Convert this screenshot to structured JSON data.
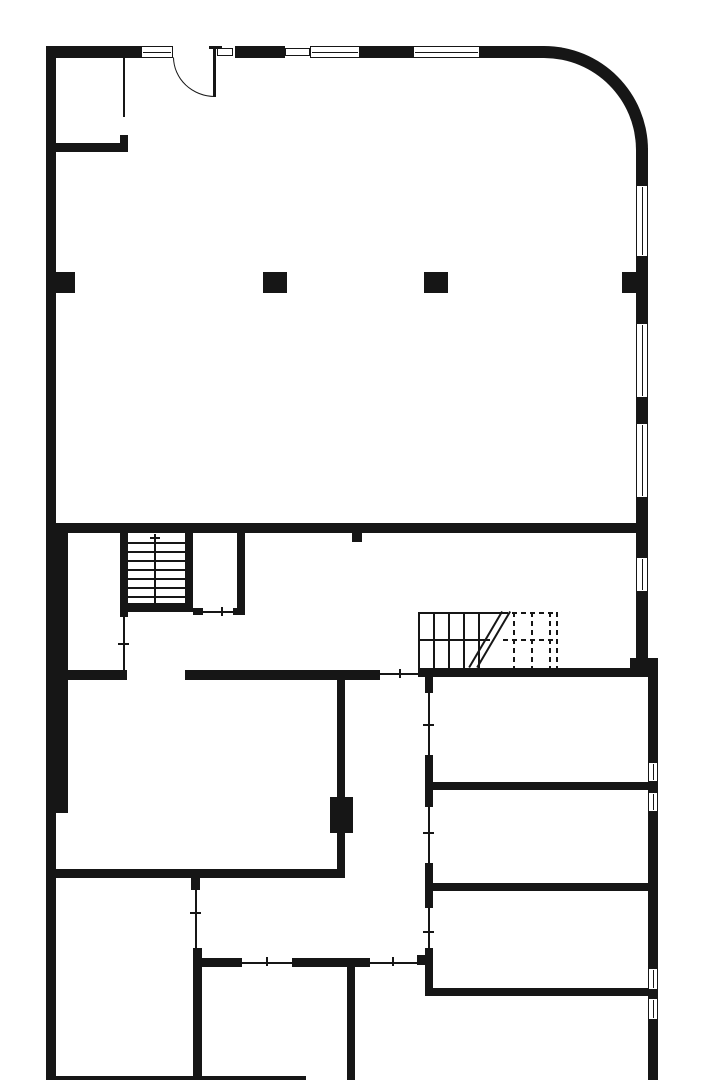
{
  "page": {
    "title": "ground-floor-plan",
    "background_color": "#ffffff",
    "ink_color": "#161616",
    "canvas_width": 720,
    "canvas_height": 1080
  },
  "elements": [
    {
      "name": "outer-wall-left",
      "type": "rect",
      "x": 46,
      "y": 48,
      "w": 10,
      "h": 1032
    },
    {
      "name": "wall-left-inner-thickening",
      "type": "rect",
      "x": 56,
      "y": 525,
      "w": 12,
      "h": 288
    },
    {
      "name": "top-wall-segment",
      "type": "rect",
      "x": 46,
      "y": 46,
      "w": 95,
      "h": 12
    },
    {
      "name": "window",
      "type": "window",
      "x": 141,
      "y": 46,
      "w": 32,
      "h": 12,
      "mid": true
    },
    {
      "name": "door-leaf",
      "type": "rect",
      "x": 213,
      "y": 47,
      "w": 3,
      "h": 50
    },
    {
      "name": "door-hinge-cap",
      "type": "rect",
      "x": 209,
      "y": 46,
      "w": 13,
      "h": 3
    },
    {
      "name": "door-swing-arc",
      "type": "arc",
      "x": 173,
      "y": 57,
      "w": 42,
      "h": 40
    },
    {
      "name": "window-sill",
      "type": "window",
      "x": 217,
      "y": 48,
      "w": 16,
      "h": 8
    },
    {
      "name": "top-wall-segment",
      "type": "rect",
      "x": 235,
      "y": 46,
      "w": 50,
      "h": 12
    },
    {
      "name": "window",
      "type": "window",
      "x": 285,
      "y": 48,
      "w": 25,
      "h": 8
    },
    {
      "name": "window",
      "type": "window",
      "x": 310,
      "y": 46,
      "w": 50,
      "h": 12,
      "mid": true
    },
    {
      "name": "top-wall-segment",
      "type": "rect",
      "x": 360,
      "y": 46,
      "w": 53,
      "h": 12
    },
    {
      "name": "window",
      "type": "window",
      "x": 413,
      "y": 46,
      "w": 67,
      "h": 12,
      "mid": true
    },
    {
      "name": "curved-corner-wall",
      "type": "corner",
      "x": 480,
      "y": 46,
      "w": 168,
      "h": 104
    },
    {
      "name": "right-wall-segment",
      "type": "rect",
      "x": 636,
      "y": 148,
      "w": 12,
      "h": 37
    },
    {
      "name": "window",
      "type": "window",
      "x": 636,
      "y": 185,
      "w": 12,
      "h": 72,
      "mid": true
    },
    {
      "name": "right-wall-segment",
      "type": "rect",
      "x": 636,
      "y": 257,
      "w": 12,
      "h": 16
    },
    {
      "name": "pilaster-column",
      "type": "rect",
      "x": 622,
      "y": 272,
      "w": 26,
      "h": 21
    },
    {
      "name": "right-wall-segment",
      "type": "rect",
      "x": 636,
      "y": 293,
      "w": 12,
      "h": 30
    },
    {
      "name": "window",
      "type": "window",
      "x": 636,
      "y": 323,
      "w": 12,
      "h": 75,
      "mid": true
    },
    {
      "name": "right-wall-segment",
      "type": "rect",
      "x": 636,
      "y": 398,
      "w": 12,
      "h": 25
    },
    {
      "name": "window",
      "type": "window",
      "x": 636,
      "y": 423,
      "w": 12,
      "h": 75,
      "mid": true
    },
    {
      "name": "right-wall-segment",
      "type": "rect",
      "x": 636,
      "y": 498,
      "w": 12,
      "h": 59
    },
    {
      "name": "window",
      "type": "window",
      "x": 636,
      "y": 557,
      "w": 12,
      "h": 35,
      "mid": true
    },
    {
      "name": "right-wall-segment",
      "type": "rect",
      "x": 636,
      "y": 592,
      "w": 12,
      "h": 76
    },
    {
      "name": "right-wall-joint",
      "type": "rect",
      "x": 630,
      "y": 658,
      "w": 28,
      "h": 12
    },
    {
      "name": "right-wall-lower-segment",
      "type": "rect",
      "x": 648,
      "y": 668,
      "w": 10,
      "h": 94
    },
    {
      "name": "window",
      "type": "window",
      "x": 648,
      "y": 762,
      "w": 10,
      "h": 20,
      "mid": true
    },
    {
      "name": "right-wall-lower-segment",
      "type": "rect",
      "x": 648,
      "y": 782,
      "w": 10,
      "h": 10
    },
    {
      "name": "window",
      "type": "window",
      "x": 648,
      "y": 792,
      "w": 10,
      "h": 20,
      "mid": true
    },
    {
      "name": "right-wall-lower-segment",
      "type": "rect",
      "x": 648,
      "y": 812,
      "w": 10,
      "h": 156
    },
    {
      "name": "window",
      "type": "window",
      "x": 648,
      "y": 968,
      "w": 10,
      "h": 22,
      "mid": true
    },
    {
      "name": "right-wall-lower-segment",
      "type": "rect",
      "x": 648,
      "y": 990,
      "w": 10,
      "h": 8
    },
    {
      "name": "window",
      "type": "window",
      "x": 648,
      "y": 998,
      "w": 10,
      "h": 22,
      "mid": true
    },
    {
      "name": "right-wall-lower-segment",
      "type": "rect",
      "x": 648,
      "y": 1020,
      "w": 10,
      "h": 60
    },
    {
      "name": "bottom-wall",
      "type": "rect",
      "x": 46,
      "y": 1076,
      "w": 260,
      "h": 4
    },
    {
      "name": "partition-glazed",
      "type": "rect",
      "x": 123,
      "y": 58,
      "w": 2,
      "h": 59
    },
    {
      "name": "partition-post",
      "type": "rect",
      "x": 120,
      "y": 135,
      "w": 8,
      "h": 17
    },
    {
      "name": "room-wall",
      "type": "rect",
      "x": 46,
      "y": 143,
      "w": 82,
      "h": 9
    },
    {
      "name": "pilaster-column",
      "type": "rect",
      "x": 52,
      "y": 272,
      "w": 23,
      "h": 21
    },
    {
      "name": "column",
      "type": "rect",
      "x": 263,
      "y": 272,
      "w": 24,
      "h": 21
    },
    {
      "name": "column",
      "type": "rect",
      "x": 424,
      "y": 272,
      "w": 24,
      "h": 21
    },
    {
      "name": "main-cross-wall",
      "type": "rect",
      "x": 46,
      "y": 523,
      "w": 602,
      "h": 10
    },
    {
      "name": "wall-stub",
      "type": "rect",
      "x": 352,
      "y": 533,
      "w": 10,
      "h": 9
    },
    {
      "name": "stair-wall-west",
      "type": "rect",
      "x": 120,
      "y": 533,
      "w": 8,
      "h": 84
    },
    {
      "name": "stair-partition-glazed",
      "type": "rect",
      "x": 123,
      "y": 617,
      "w": 2,
      "h": 53
    },
    {
      "name": "tick-mark",
      "type": "rect",
      "x": 118,
      "y": 643,
      "w": 11,
      "h": 2
    },
    {
      "name": "stair-wall-east",
      "type": "rect",
      "x": 185,
      "y": 533,
      "w": 8,
      "h": 70
    },
    {
      "name": "stair-tread",
      "type": "rect",
      "x": 128,
      "y": 542,
      "w": 57,
      "h": 2
    },
    {
      "name": "stair-tread",
      "type": "rect",
      "x": 128,
      "y": 551,
      "w": 57,
      "h": 2
    },
    {
      "name": "stair-tread",
      "type": "rect",
      "x": 128,
      "y": 560,
      "w": 57,
      "h": 2
    },
    {
      "name": "stair-tread",
      "type": "rect",
      "x": 128,
      "y": 569,
      "w": 57,
      "h": 2
    },
    {
      "name": "stair-tread",
      "type": "rect",
      "x": 128,
      "y": 578,
      "w": 57,
      "h": 2
    },
    {
      "name": "stair-tread",
      "type": "rect",
      "x": 128,
      "y": 587,
      "w": 57,
      "h": 2
    },
    {
      "name": "stair-tread",
      "type": "rect",
      "x": 128,
      "y": 596,
      "w": 57,
      "h": 2
    },
    {
      "name": "stair-center-line",
      "type": "rect",
      "x": 154,
      "y": 534,
      "w": 2,
      "h": 69
    },
    {
      "name": "stair-direction-arrow",
      "type": "rect",
      "x": 150,
      "y": 537,
      "w": 10,
      "h": 2
    },
    {
      "name": "stair-wall-south",
      "type": "rect",
      "x": 120,
      "y": 603,
      "w": 73,
      "h": 9
    },
    {
      "name": "room-wall-east",
      "type": "rect",
      "x": 237,
      "y": 533,
      "w": 8,
      "h": 76
    },
    {
      "name": "door-jamb",
      "type": "rect",
      "x": 193,
      "y": 608,
      "w": 10,
      "h": 7
    },
    {
      "name": "door-line",
      "type": "rect",
      "x": 203,
      "y": 611,
      "w": 30,
      "h": 2
    },
    {
      "name": "tick-mark",
      "type": "rect",
      "x": 221,
      "y": 607,
      "w": 2,
      "h": 9
    },
    {
      "name": "door-jamb",
      "type": "rect",
      "x": 233,
      "y": 608,
      "w": 12,
      "h": 7
    },
    {
      "name": "corridor-wall",
      "type": "rect",
      "x": 46,
      "y": 670,
      "w": 81,
      "h": 10
    },
    {
      "name": "corridor-wall",
      "type": "rect",
      "x": 185,
      "y": 670,
      "w": 195,
      "h": 10
    },
    {
      "name": "opening-line",
      "type": "rect",
      "x": 380,
      "y": 673,
      "w": 38,
      "h": 2
    },
    {
      "name": "tick-mark",
      "type": "rect",
      "x": 399,
      "y": 669,
      "w": 2,
      "h": 9
    },
    {
      "name": "room-wall",
      "type": "rect",
      "x": 46,
      "y": 869,
      "w": 299,
      "h": 9
    },
    {
      "name": "room-wall-vertical",
      "type": "rect",
      "x": 337,
      "y": 680,
      "w": 8,
      "h": 189
    },
    {
      "name": "wall-block",
      "type": "rect",
      "x": 330,
      "y": 797,
      "w": 23,
      "h": 36
    },
    {
      "name": "partition-post",
      "type": "rect",
      "x": 191,
      "y": 878,
      "w": 9,
      "h": 12
    },
    {
      "name": "partition-glazed",
      "type": "rect",
      "x": 195,
      "y": 890,
      "w": 2,
      "h": 58
    },
    {
      "name": "tick-mark",
      "type": "rect",
      "x": 190,
      "y": 912,
      "w": 11,
      "h": 2
    },
    {
      "name": "room-wall-vertical",
      "type": "rect",
      "x": 193,
      "y": 948,
      "w": 9,
      "h": 132
    },
    {
      "name": "room-wall",
      "type": "rect",
      "x": 202,
      "y": 958,
      "w": 40,
      "h": 9
    },
    {
      "name": "opening-line",
      "type": "rect",
      "x": 242,
      "y": 962,
      "w": 50,
      "h": 2
    },
    {
      "name": "tick-mark",
      "type": "rect",
      "x": 266,
      "y": 957,
      "w": 2,
      "h": 9
    },
    {
      "name": "room-wall",
      "type": "rect",
      "x": 292,
      "y": 958,
      "w": 78,
      "h": 9
    },
    {
      "name": "opening-line",
      "type": "rect",
      "x": 370,
      "y": 962,
      "w": 47,
      "h": 2
    },
    {
      "name": "tick-mark",
      "type": "rect",
      "x": 392,
      "y": 957,
      "w": 2,
      "h": 9
    },
    {
      "name": "room-wall-vertical",
      "type": "rect",
      "x": 347,
      "y": 962,
      "w": 8,
      "h": 118
    },
    {
      "name": "wall-corner",
      "type": "rect",
      "x": 417,
      "y": 955,
      "w": 16,
      "h": 10
    },
    {
      "name": "stair2-top-edge",
      "type": "rect",
      "x": 418,
      "y": 612,
      "w": 85,
      "h": 2
    },
    {
      "name": "stair2-top-edge-dashed",
      "type": "dashed",
      "x": 503,
      "y": 612,
      "w": 55,
      "h": 2
    },
    {
      "name": "stair2-left-edge",
      "type": "rect",
      "x": 418,
      "y": 612,
      "w": 2,
      "h": 56
    },
    {
      "name": "stair2-tread",
      "type": "rect",
      "x": 433,
      "y": 612,
      "w": 2,
      "h": 56
    },
    {
      "name": "stair2-tread",
      "type": "rect",
      "x": 448,
      "y": 612,
      "w": 2,
      "h": 56
    },
    {
      "name": "stair2-tread",
      "type": "rect",
      "x": 463,
      "y": 612,
      "w": 2,
      "h": 56
    },
    {
      "name": "stair2-tread",
      "type": "rect",
      "x": 478,
      "y": 612,
      "w": 2,
      "h": 56
    },
    {
      "name": "stair2-mid-line",
      "type": "rect",
      "x": 418,
      "y": 639,
      "w": 72,
      "h": 2
    },
    {
      "name": "stair2-mid-line-dashed",
      "type": "dashed",
      "x": 503,
      "y": 639,
      "w": 55,
      "h": 2
    },
    {
      "name": "stair2-tread-dashed",
      "type": "dashed",
      "x": 513,
      "y": 612,
      "w": 2,
      "h": 56
    },
    {
      "name": "stair2-tread-dashed",
      "type": "dashed",
      "x": 531,
      "y": 612,
      "w": 2,
      "h": 56
    },
    {
      "name": "stair2-tread-dashed",
      "type": "dashed",
      "x": 549,
      "y": 612,
      "w": 2,
      "h": 56
    },
    {
      "name": "stair2-right-edge-dashed",
      "type": "dashed",
      "x": 556,
      "y": 612,
      "w": 2,
      "h": 56
    },
    {
      "name": "stair2-break-line",
      "type": "diag",
      "x1": 470,
      "y1": 668,
      "x2": 503,
      "y2": 612
    },
    {
      "name": "stair2-break-line",
      "type": "diag",
      "x1": 478,
      "y1": 668,
      "x2": 511,
      "y2": 612
    },
    {
      "name": "section-wall",
      "type": "rect",
      "x": 418,
      "y": 668,
      "w": 232,
      "h": 9
    },
    {
      "name": "partition-post",
      "type": "rect",
      "x": 425,
      "y": 677,
      "w": 8,
      "h": 16
    },
    {
      "name": "partition-glazed",
      "type": "rect",
      "x": 428,
      "y": 693,
      "w": 2,
      "h": 62
    },
    {
      "name": "tick-mark",
      "type": "rect",
      "x": 423,
      "y": 724,
      "w": 11,
      "h": 2
    },
    {
      "name": "partition-post",
      "type": "rect",
      "x": 425,
      "y": 755,
      "w": 8,
      "h": 52
    },
    {
      "name": "partition-glazed",
      "type": "rect",
      "x": 428,
      "y": 807,
      "w": 2,
      "h": 56
    },
    {
      "name": "tick-mark",
      "type": "rect",
      "x": 423,
      "y": 832,
      "w": 11,
      "h": 2
    },
    {
      "name": "partition-post",
      "type": "rect",
      "x": 425,
      "y": 863,
      "w": 8,
      "h": 45
    },
    {
      "name": "partition-glazed",
      "type": "rect",
      "x": 428,
      "y": 908,
      "w": 2,
      "h": 40
    },
    {
      "name": "tick-mark",
      "type": "rect",
      "x": 423,
      "y": 931,
      "w": 11,
      "h": 2
    },
    {
      "name": "partition-post",
      "type": "rect",
      "x": 425,
      "y": 948,
      "w": 8,
      "h": 47
    },
    {
      "name": "room-divider-wall",
      "type": "rect",
      "x": 425,
      "y": 782,
      "w": 223,
      "h": 8
    },
    {
      "name": "room-divider-wall",
      "type": "rect",
      "x": 425,
      "y": 883,
      "w": 223,
      "h": 8
    },
    {
      "name": "room-divider-wall",
      "type": "rect",
      "x": 425,
      "y": 988,
      "w": 223,
      "h": 8
    }
  ]
}
